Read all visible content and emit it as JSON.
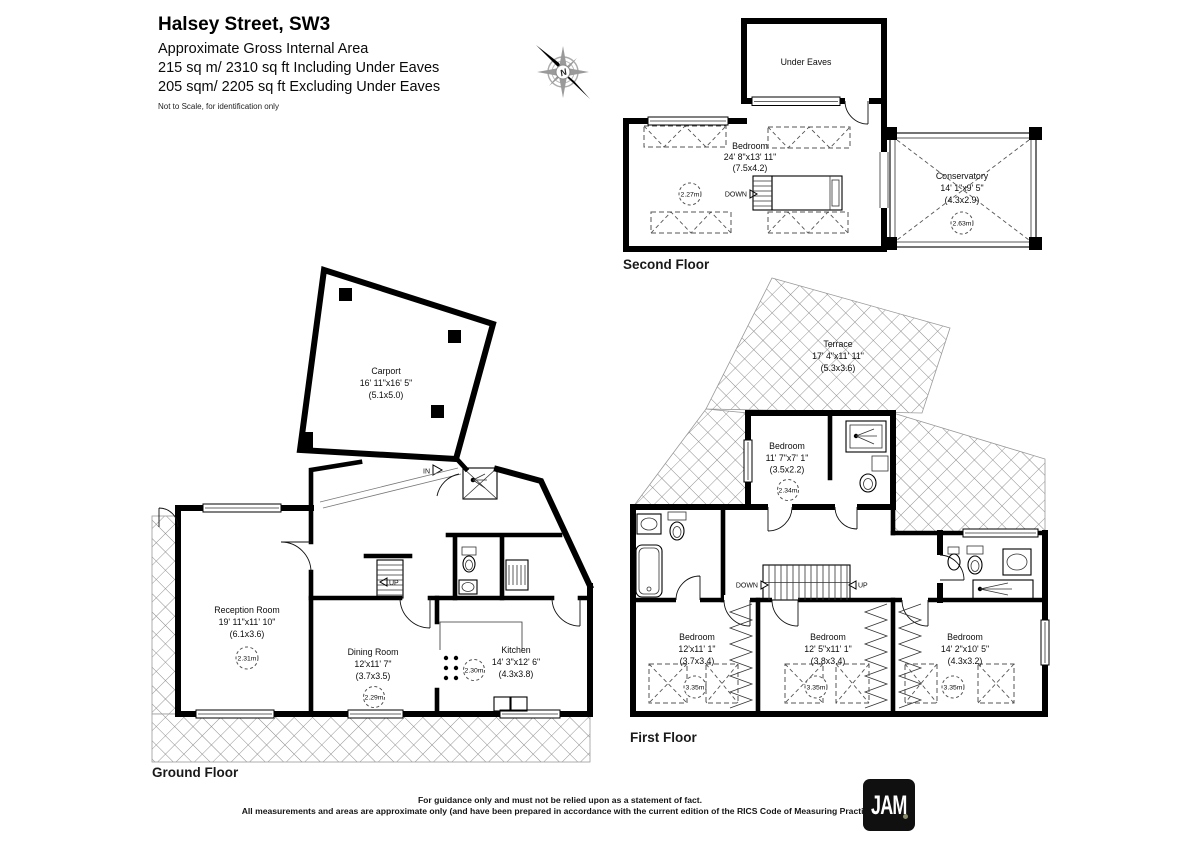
{
  "header": {
    "title": "Halsey Street, SW3",
    "subtitle": "Approximate Gross Internal Area",
    "area_including": "215 sq m/ 2310 sq ft Including Under Eaves",
    "area_excluding": "205 sqm/ 2205 sq ft Excluding Under Eaves",
    "scale_note": "Not to Scale, for identification only"
  },
  "compass": {
    "north_label": "N"
  },
  "floors": {
    "second": {
      "label": "Second Floor",
      "under_eaves": {
        "name": "Under Eaves"
      },
      "bedroom": {
        "name": "Bedroom",
        "dims_ft": "24' 8\"x13' 11\"",
        "dims_m": "(7.5x4.2)",
        "ceiling_height": "2.27m"
      },
      "conservatory": {
        "name": "Conservatory",
        "dims_ft": "14' 1\"x9' 5\"",
        "dims_m": "(4.3x2.9)",
        "ceiling_height": "2.63m"
      },
      "stairs_label": "DOWN"
    },
    "ground": {
      "label": "Ground Floor",
      "carport": {
        "name": "Carport",
        "dims_ft": "16' 11\"x16' 5\"",
        "dims_m": "(5.1x5.0)"
      },
      "reception": {
        "name": "Reception Room",
        "dims_ft": "19' 11\"x11' 10\"",
        "dims_m": "(6.1x3.6)",
        "ceiling_height": "2.31m"
      },
      "dining": {
        "name": "Dining Room",
        "dims_ft": "12'x11' 7\"",
        "dims_m": "(3.7x3.5)",
        "ceiling_height": "2.29m"
      },
      "kitchen": {
        "name": "Kitchen",
        "dims_ft": "14' 3\"x12' 6\"",
        "dims_m": "(4.3x3.8)",
        "ceiling_height": "2.30m"
      },
      "stairs_label": "UP",
      "entrance_label": "IN"
    },
    "first": {
      "label": "First Floor",
      "terrace": {
        "name": "Terrace",
        "dims_ft": "17' 4\"x11' 11\"",
        "dims_m": "(5.3x3.6)"
      },
      "bedroom_top": {
        "name": "Bedroom",
        "dims_ft": "11' 7\"x7' 1\"",
        "dims_m": "(3.5x2.2)",
        "ceiling_height": "2.34m"
      },
      "bedroom_left": {
        "name": "Bedroom",
        "dims_ft": "12'x11' 1\"",
        "dims_m": "(3.7x3.4)",
        "ceiling_height": "3.35m"
      },
      "bedroom_middle": {
        "name": "Bedroom",
        "dims_ft": "12' 5\"x11' 1\"",
        "dims_m": "(3.8x3.4)",
        "ceiling_height": "3.35m"
      },
      "bedroom_right": {
        "name": "Bedroom",
        "dims_ft": "14' 2\"x10' 5\"",
        "dims_m": "(4.3x3.2)",
        "ceiling_height": "3.35m"
      },
      "stairs_down_label": "DOWN",
      "stairs_up_label": "UP"
    }
  },
  "footer": {
    "disclaimer_line1": "For guidance only and must not be relied upon as a statement of fact.",
    "disclaimer_line2": "All measurements and areas are approximate only (and have been prepared in accordance with the current edition of the RICS Code of Measuring Practice).",
    "logo_text": "JAM"
  }
}
